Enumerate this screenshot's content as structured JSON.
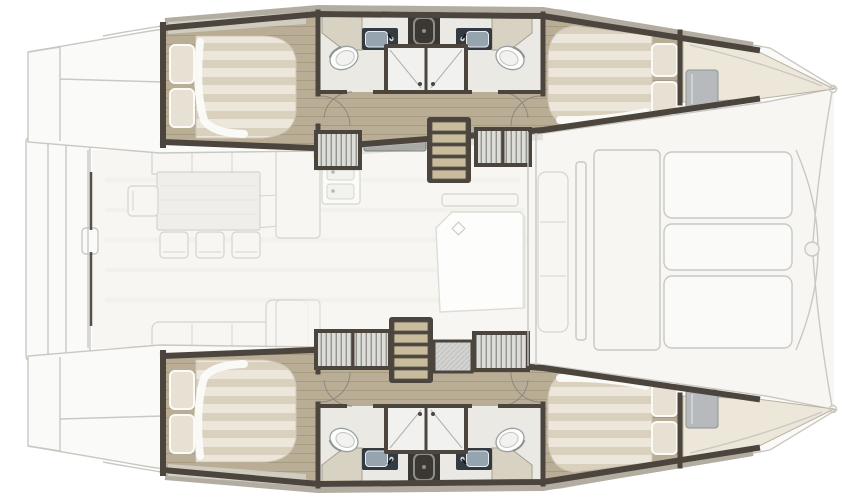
{
  "meta": {
    "title": "Catamaran yacht floor plan",
    "description": "Top-down deck plan of a four-cabin, four-head sailing catamaran: twin hulls with double berths fore and aft, en-suite heads with showers amidships, central saloon with L-settee, dining table, galley and island unit, companionway stairs into each hull, aft swim platform and forward cockpit benches. Bow points right.",
    "orientation": {
      "bow": "right",
      "stern": "left"
    }
  },
  "colors": {
    "wall": "#4b453e",
    "gunwale": "#b2aca1",
    "wood": "#b9ae95",
    "woodLine": "#a79b81",
    "stairWood": "#c9bc9d",
    "mattress": "#ece7da",
    "mattressStripe": "#d9d1bd",
    "pillow": "#e6e1d3",
    "counterBeige": "#d8d2c3",
    "bathFloor": "#eae9e4",
    "sinkFrame": "#343a41",
    "sinkBasin": "#95a4af",
    "fixtureDark": "#3b3833",
    "tambourBase": "#dcdcd9",
    "tambourLine": "#77766f",
    "hatch": "#d2d3d0",
    "grayPad": "#b7babc",
    "faint": "#c9c8c3",
    "faintFill": "#fafaf8",
    "saloonFill": "#f7f6f2",
    "furnFill": "#f7f6f2",
    "furnLine": "#d5d4cf",
    "shadow": "rgba(60,55,48,0.10)"
  },
  "vessel": {
    "hulls": [
      {
        "id": "port-hull",
        "position": "top",
        "cabins": [
          {
            "name": "aft-cabin",
            "furniture": [
              "double-berth",
              "two-pillows",
              "shelf"
            ]
          },
          {
            "name": "forward-cabin",
            "furniture": [
              "double-berth",
              "two-pillows",
              "gray-cushion",
              "bow-shelf"
            ]
          }
        ],
        "heads": [
          {
            "name": "aft-head",
            "fixtures": [
              "toilet",
              "sink",
              "vanity-counter",
              "shower-stall"
            ]
          },
          {
            "name": "forward-head",
            "fixtures": [
              "toilet",
              "sink",
              "vanity-counter",
              "shower-stall"
            ]
          }
        ],
        "companionway": "stairs-five-treads",
        "corridor": "wood-sole-passageway"
      },
      {
        "id": "starboard-hull",
        "position": "bottom",
        "mirror_of": "port-hull"
      }
    ],
    "saloon": {
      "furniture": [
        "l-settee",
        "dining-table",
        "side-chair",
        "three-chairs",
        "aft-sofa",
        "corner-seat",
        "galley-counter",
        "galley-double-sink",
        "cooktop-panel",
        "island-unit",
        "hanging-lockers-tambour",
        "storage-hatch"
      ]
    },
    "exterior": {
      "features": [
        "aft-swim-platform",
        "transom-steps",
        "aft-sliding-door",
        "forward-cockpit-benches",
        "forward-lounge-seat",
        "bow-crossbeam",
        "bowsprit-fitting",
        "hull-bow-points"
      ]
    }
  }
}
